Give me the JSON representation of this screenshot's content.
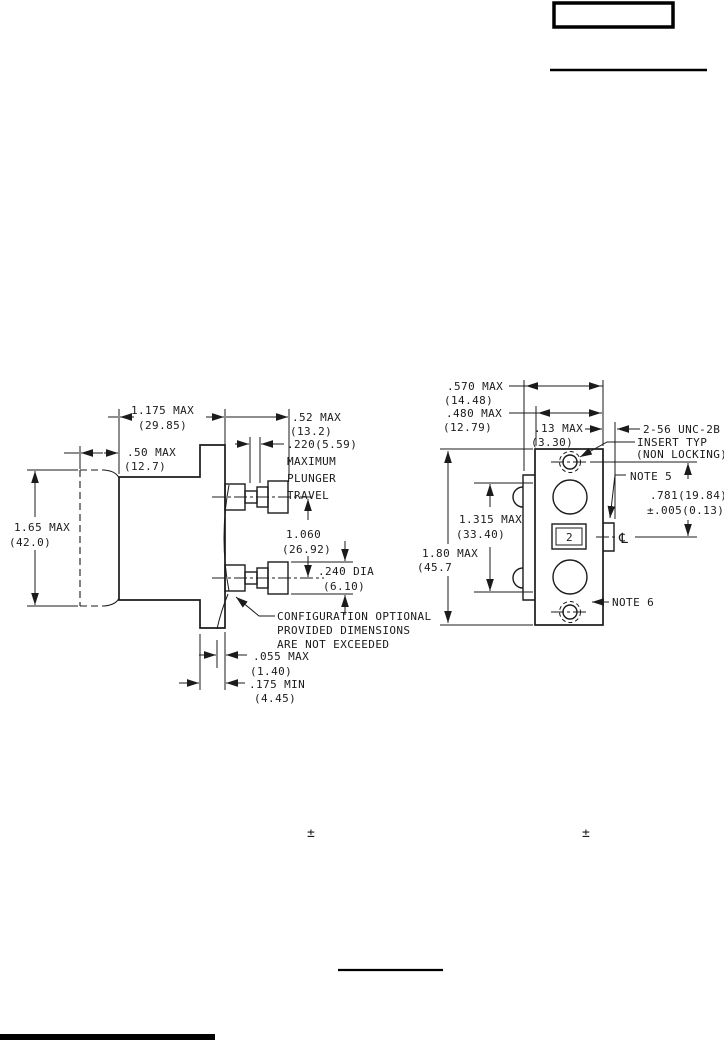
{
  "page": {
    "plus_minus_left": "±",
    "plus_minus_right": "±"
  },
  "side_view": {
    "dim_body_width": {
      "v": "1.175 MAX",
      "mm": "(29.85)"
    },
    "dim_optional_depth": {
      "v": ".50 MAX",
      "mm": "(12.7)"
    },
    "dim_plunger_ext": {
      "v": ".52 MAX",
      "mm": "(13.2)"
    },
    "dim_travel": {
      "l1": ".220(5.59)",
      "l2": "MAXIMUM",
      "l3": "PLUNGER",
      "l4": "TRAVEL"
    },
    "dim_body_height": {
      "v": "1.65 MAX",
      "mm": "(42.0)"
    },
    "dim_plunger_spacing": {
      "v": "1.060",
      "mm": "(26.92)"
    },
    "dim_plunger_dia": {
      "v": ".240 DIA",
      "mm": "(6.10)"
    },
    "config_note": {
      "l1": "CONFIGURATION OPTIONAL",
      "l2": "PROVIDED DIMENSIONS",
      "l3": "ARE NOT EXCEEDED"
    },
    "dim_panel_gap": {
      "v": ".055 MAX",
      "mm": "(1.40)"
    },
    "dim_bushing": {
      "v": ".175 MIN",
      "mm": "(4.45)"
    }
  },
  "front_view": {
    "dim_width_outer": {
      "v": ".570 MAX",
      "mm": "(14.48)"
    },
    "dim_width_body": {
      "v": ".480 MAX",
      "mm": "(12.79)"
    },
    "dim_tab": {
      "v": ".13 MAX",
      "mm": "(3.30)"
    },
    "insert_note": {
      "l1": "2-56 UNC-2B",
      "l2": "INSERT TYP",
      "l3": "(NON LOCKING)"
    },
    "note5": "NOTE 5",
    "note6": "NOTE 6",
    "dim_hole_to_center": {
      "v": ".781(19.84)",
      "tol": "±.005(0.13)"
    },
    "dim_button_span": {
      "v": "1.315 MAX",
      "mm": "(33.40)"
    },
    "dim_height": {
      "v": "1.80 MAX",
      "mm": "(45.7"
    },
    "button_label": "2",
    "centerline_symbol": "℄"
  }
}
